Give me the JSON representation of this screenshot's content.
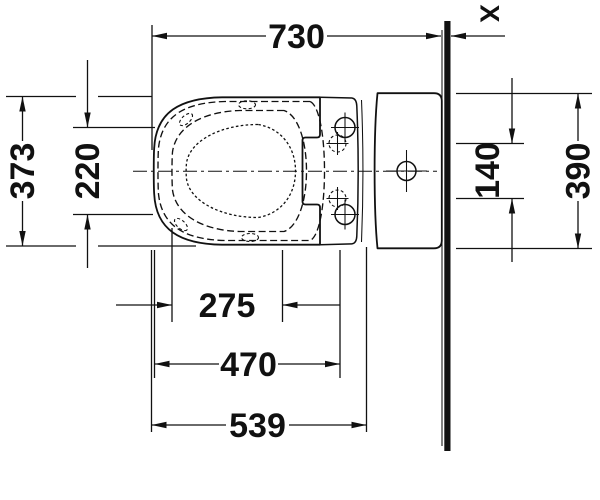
{
  "drawing": {
    "title": "toilet-top-view-dimensional-drawing",
    "section_label": "X",
    "dimensions": {
      "overall_depth_from_wall": "730",
      "seat_lid_width": "373",
      "fixing_holes_spacing_outer": "220",
      "fixing_holes_spacing_inner": "140",
      "cistern_width": "390",
      "front_to_seat_fixing": "275",
      "front_to_hinge_fixing": "470",
      "pan_front_to_cistern": "539"
    },
    "colors": {
      "line": "#111111",
      "background": "#ffffff"
    }
  }
}
